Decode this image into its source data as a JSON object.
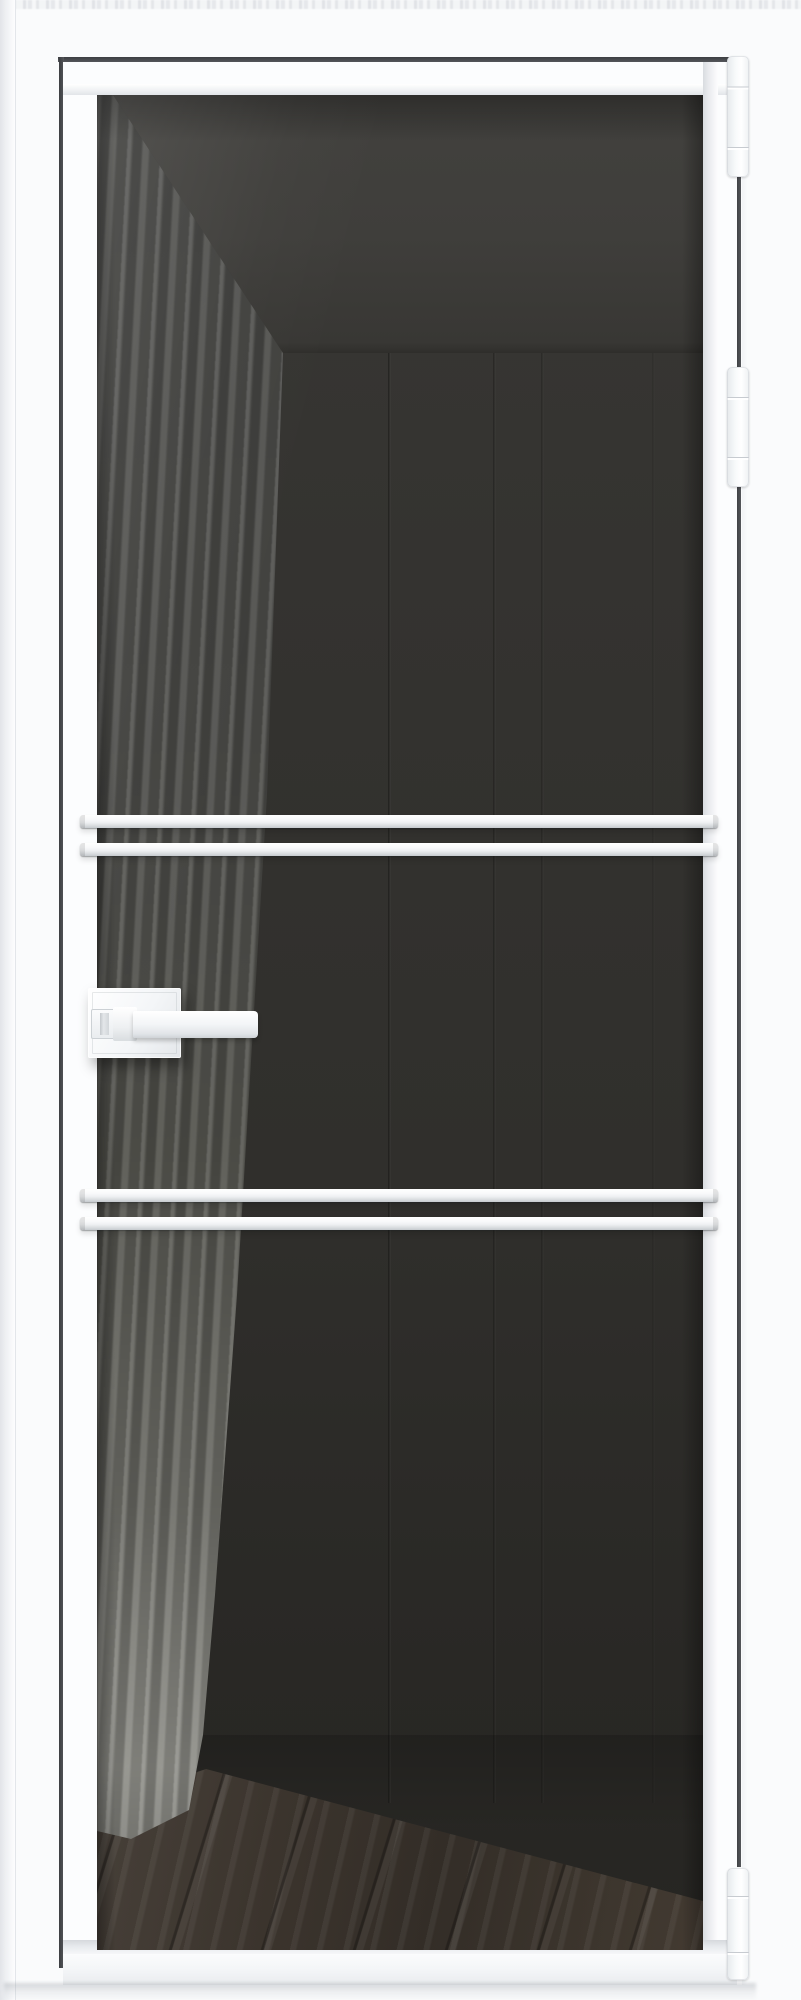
{
  "meta": {
    "description": "Product photograph of a tall white aluminium-frame interior glass door with tinted grey glazing, four white horizontal glazing bars in two pairs, a white square-rose lever handle with thumbturn on the left stile, and three white concealed hinges on the right edge; through the smoked glass a grey curtain, dark panelled wall, ceiling line and dark wood floor are visible",
    "watermark_note": "illegible pale repeating watermark strip along the very top edge"
  },
  "palette": {
    "wall": "#fafbfc",
    "frame": "#fcfdfe",
    "gapDark": "#47494c",
    "glassWall": "#343330",
    "glassCeiling": "#3f3e3b",
    "curtainTop": "#4a4a47",
    "curtainBottom": "#90908a",
    "floorA": "#474039",
    "floorB": "#332d27",
    "barShade": "#c6cace"
  },
  "door": {
    "leaf_color_name": "white",
    "glass_tint_name": "smoked grey",
    "handle": {
      "side": "left",
      "type": "lever-with-thumbturn",
      "color": "white"
    },
    "hinges": [
      {
        "top": 56,
        "height": 121
      },
      {
        "top": 367,
        "height": 120
      },
      {
        "top": 1868,
        "height": 112
      }
    ],
    "glazing_bars": [
      {
        "top": 815
      },
      {
        "top": 843
      },
      {
        "top": 1189
      },
      {
        "top": 1217
      }
    ]
  },
  "scene": {
    "wall_grooves": [
      {
        "left": 291,
        "opacity": 0.9
      },
      {
        "left": 396,
        "opacity": 0.7
      },
      {
        "left": 444,
        "opacity": 0.55
      },
      {
        "left": 555,
        "opacity": 0.3
      }
    ]
  }
}
